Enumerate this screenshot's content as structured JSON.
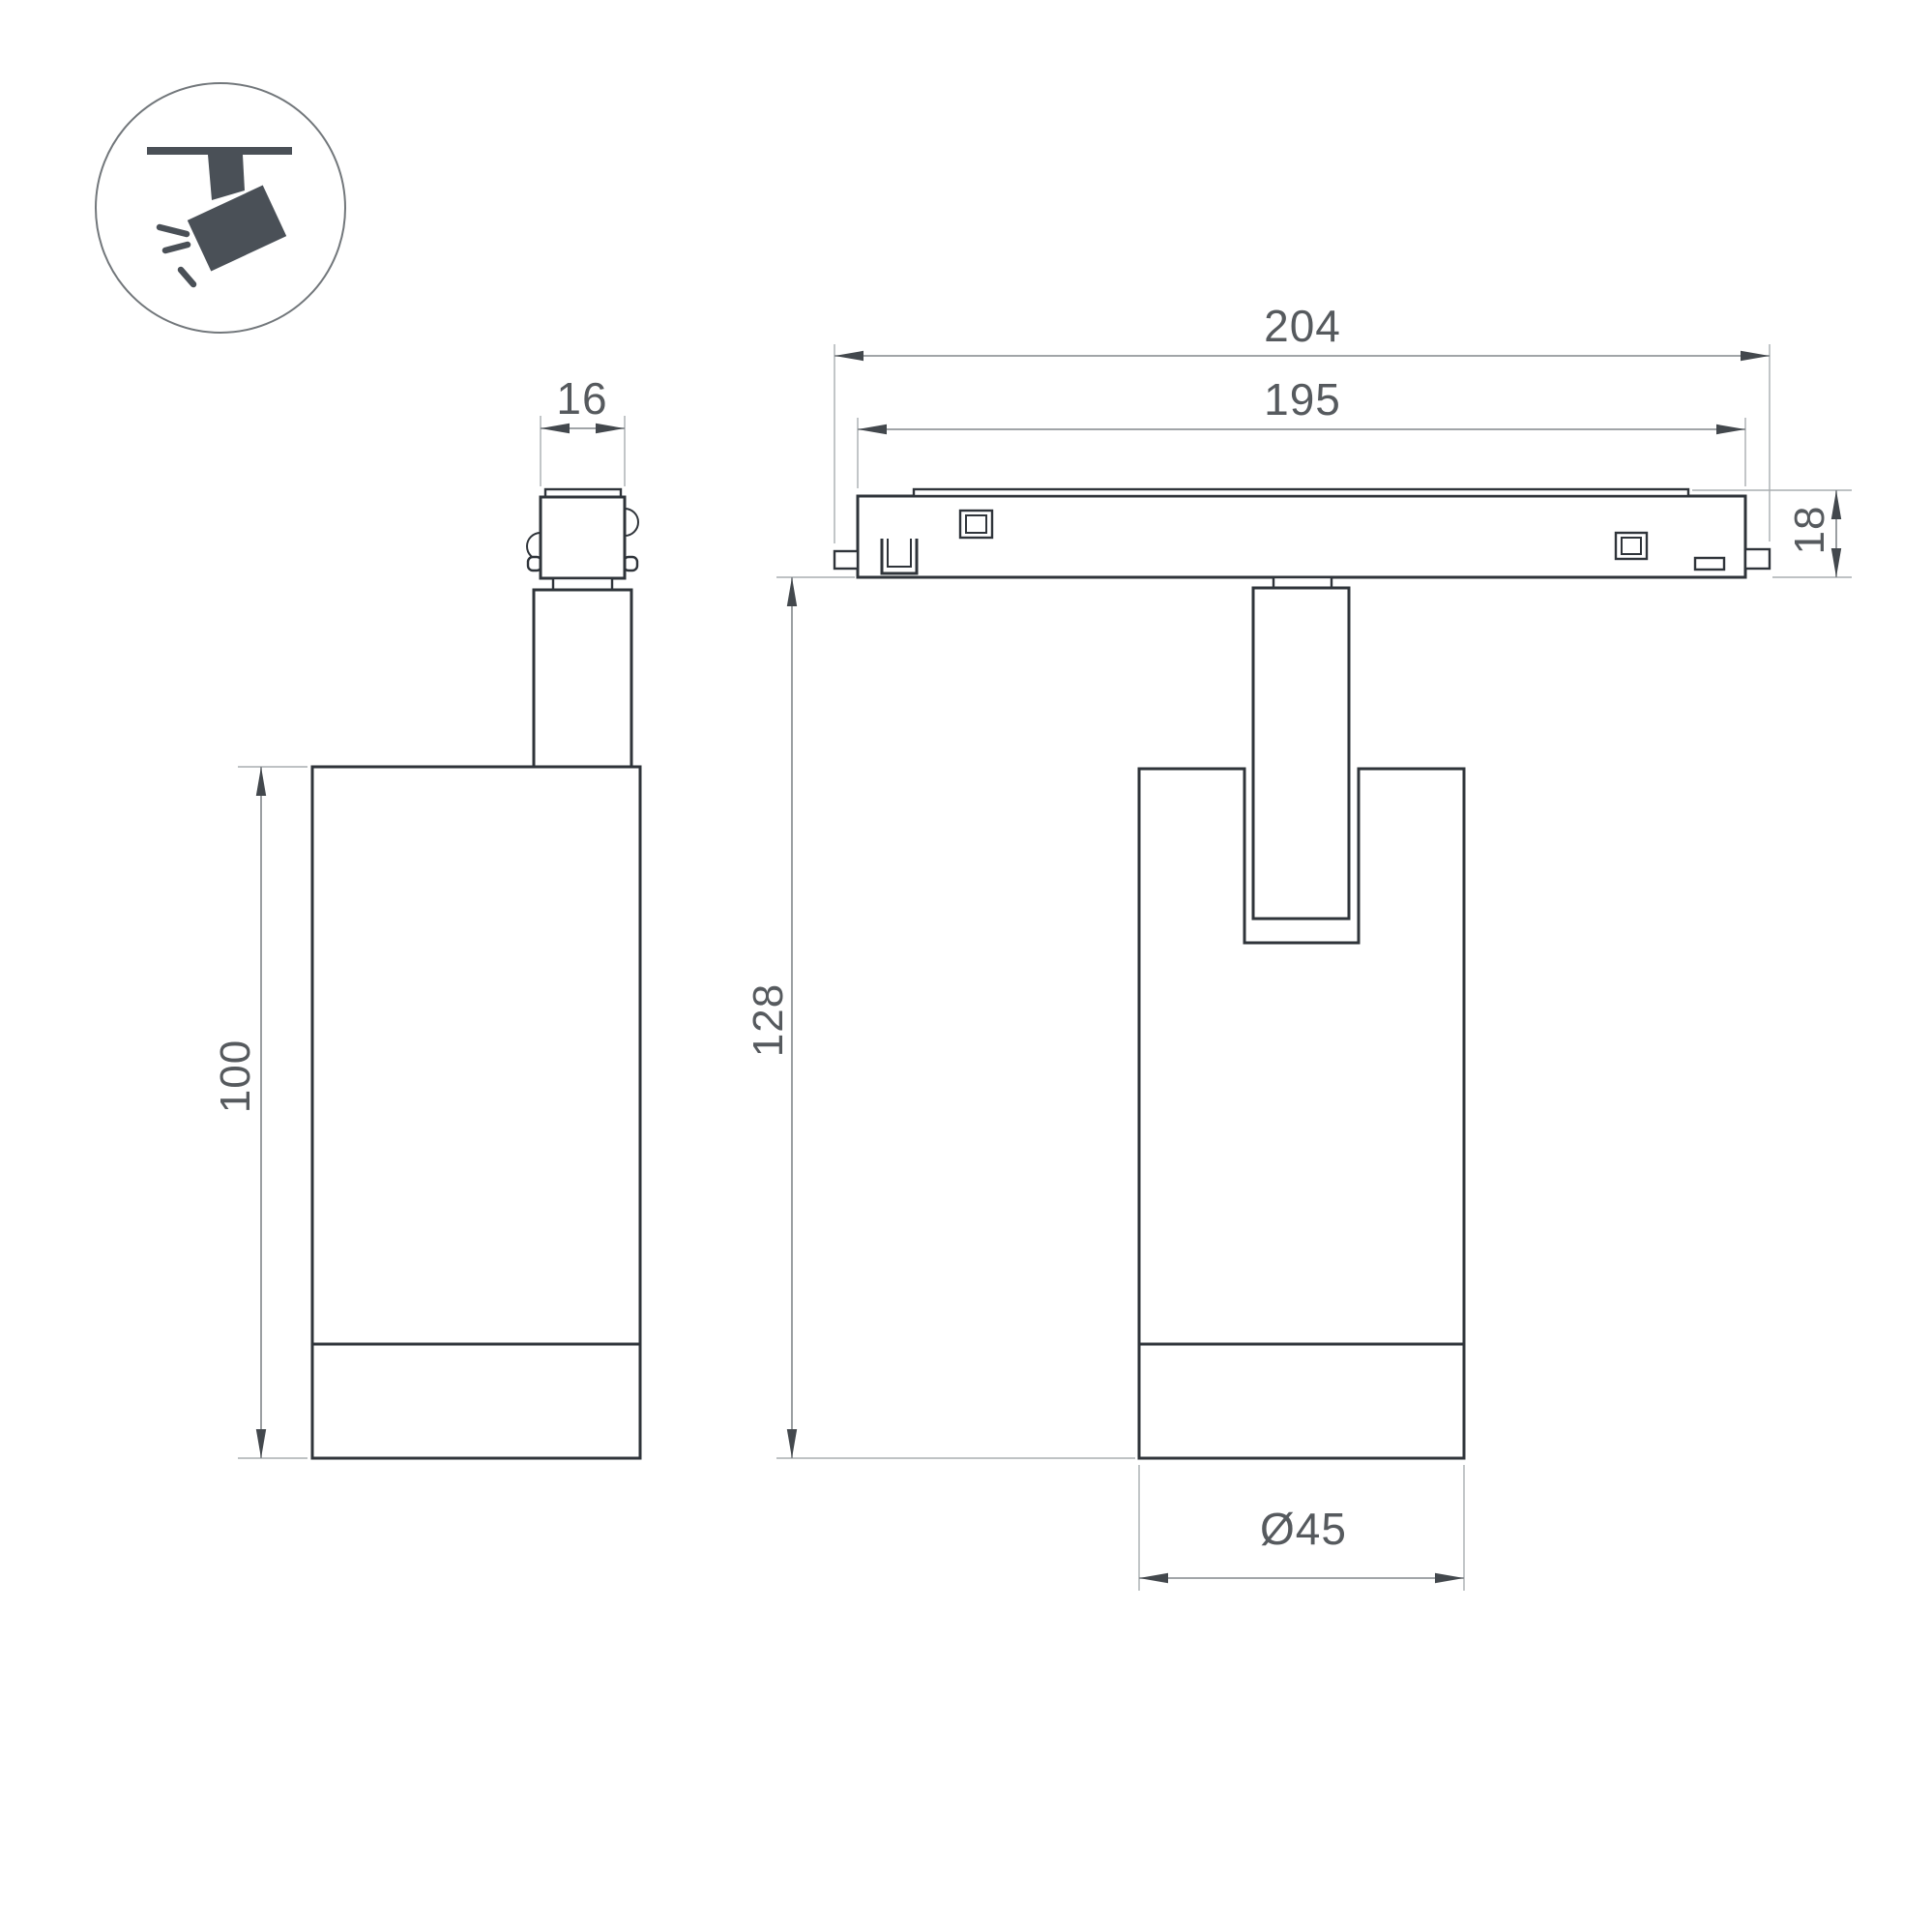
{
  "drawing": {
    "kind": "technical-dimension-drawing",
    "icon": {
      "name": "ceiling-track-spotlight-icon"
    },
    "colors": {
      "object_line": "#2f343a",
      "dimension_line": "#82878b",
      "extension_line": "#a9adb0",
      "arrow": "#43484d",
      "text": "#565a5e",
      "icon_fill": "#4a5057",
      "background": "#ffffff"
    },
    "views": {
      "side_view": {
        "dimensions": {
          "adapter_width": {
            "label": "16"
          },
          "body_height": {
            "label": "100"
          }
        }
      },
      "front_view": {
        "dimensions": {
          "track_overall_length": {
            "label": "204"
          },
          "track_body_length": {
            "label": "195"
          },
          "track_height": {
            "label": "18"
          },
          "fixture_height": {
            "label": "128"
          },
          "body_diameter": {
            "label": "Ø45"
          }
        }
      }
    }
  }
}
